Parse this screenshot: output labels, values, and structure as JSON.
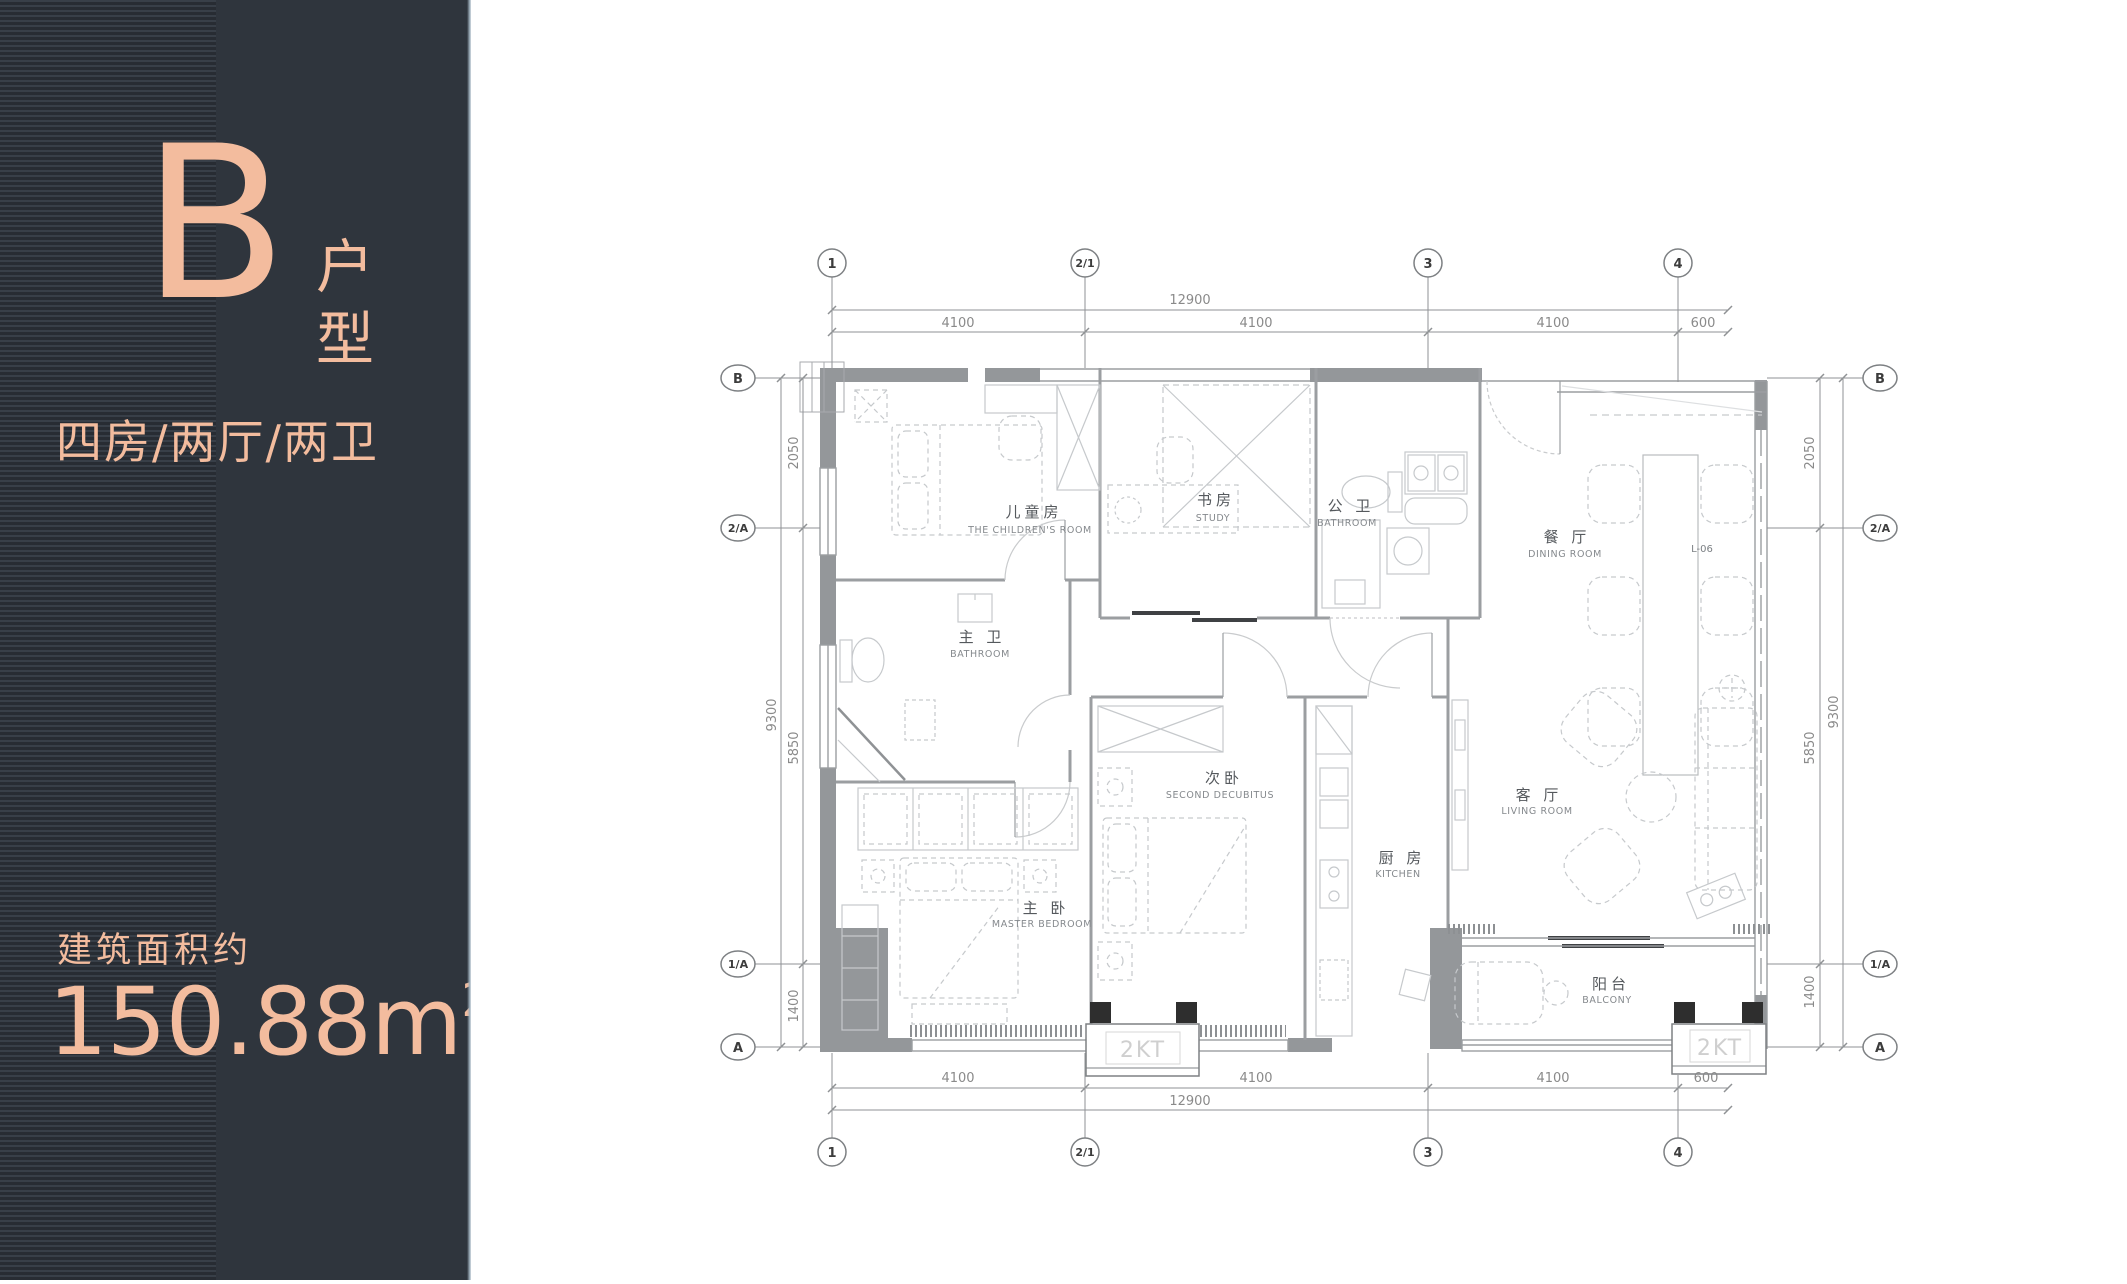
{
  "panel": {
    "letter": "B",
    "type_label_chars": [
      "户",
      "型"
    ],
    "layout": "四房/两厅/两卫",
    "area_caption": "建筑面积约",
    "area_value": "150.88m",
    "area_sup": "2",
    "accent": "#F3BC9E",
    "background": "#2F353D"
  },
  "plan": {
    "grid": {
      "top": [
        "1",
        "2/1",
        "3",
        "4"
      ],
      "bottom": [
        "1",
        "2/1",
        "3",
        "4"
      ],
      "left": [
        "B",
        "2/A",
        "1/A",
        "A"
      ],
      "right": [
        "B",
        "2/A",
        "1/A",
        "A"
      ]
    },
    "dims": {
      "top_total": "12900",
      "top_segments": [
        "4100",
        "4100",
        "4100",
        "600"
      ],
      "bottom_total": "12900",
      "bottom_segments": [
        "4100",
        "4100",
        "4100",
        "600"
      ],
      "left_total": "9300",
      "left_segments": [
        "2050",
        "5850",
        "1400"
      ],
      "right_total": "9300",
      "right_segments": [
        "2050",
        "5850",
        "1400"
      ]
    },
    "rooms": [
      {
        "zh": "儿童房",
        "en": "THE CHILDREN'S ROOM"
      },
      {
        "zh": "书房",
        "en": "STUDY"
      },
      {
        "zh": "主 卫",
        "en": "BATHROOM"
      },
      {
        "zh": "公 卫",
        "en": "BATHROOM"
      },
      {
        "zh": "餐 厅",
        "en": "DINING ROOM"
      },
      {
        "zh": "次卧",
        "en": "SECOND DECUBITUS"
      },
      {
        "zh": "厨 房",
        "en": "KITCHEN"
      },
      {
        "zh": "客 厅",
        "en": "LIVING ROOM"
      },
      {
        "zh": "主 卧",
        "en": "MASTER BEDROOM"
      },
      {
        "zh": "阳台",
        "en": "BALCONY"
      }
    ],
    "tags": {
      "bay1": "2KT",
      "bay2": "2KT",
      "dining_code": "L-06"
    }
  }
}
